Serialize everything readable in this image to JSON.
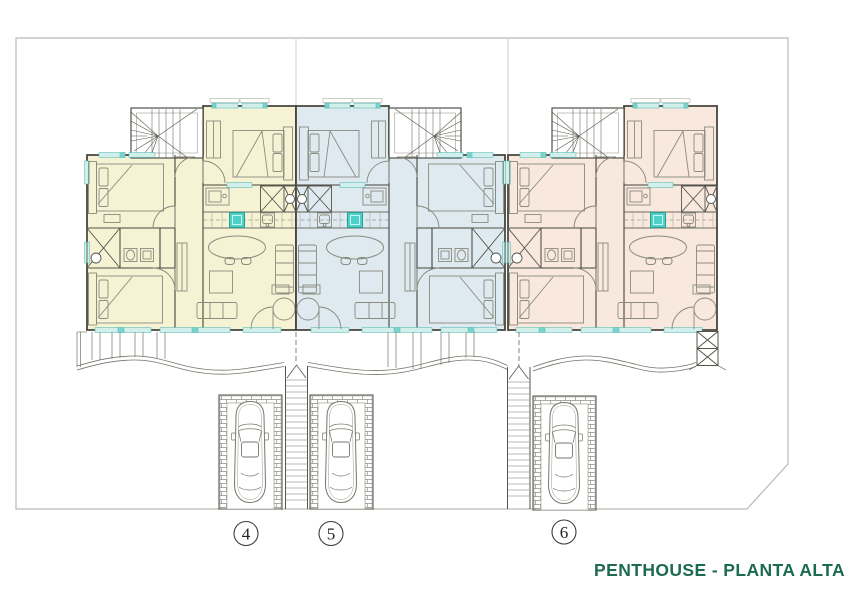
{
  "document": {
    "kind": "architectural-floor-plan"
  },
  "title": {
    "text": "PENTHOUSE - PLANTA ALTA",
    "color": "#1d6b4f"
  },
  "badges": [
    {
      "number": "4"
    },
    {
      "number": "5"
    },
    {
      "number": "6"
    }
  ],
  "units": [
    {
      "id": "4",
      "fill": "#f5f3d4",
      "position": "left"
    },
    {
      "id": "5",
      "fill": "#dee9f0",
      "position": "center"
    },
    {
      "id": "6",
      "fill": "#f8e8dd",
      "position": "right"
    }
  ],
  "palette": {
    "window_teal_light": "#d2efec",
    "window_teal_dark": "#79d4cc",
    "sink_teal": "#4fd0c6",
    "wall_gray": "#45453c",
    "boundary_gray": "#b9b9b5",
    "title_green": "#1d6b4f"
  }
}
